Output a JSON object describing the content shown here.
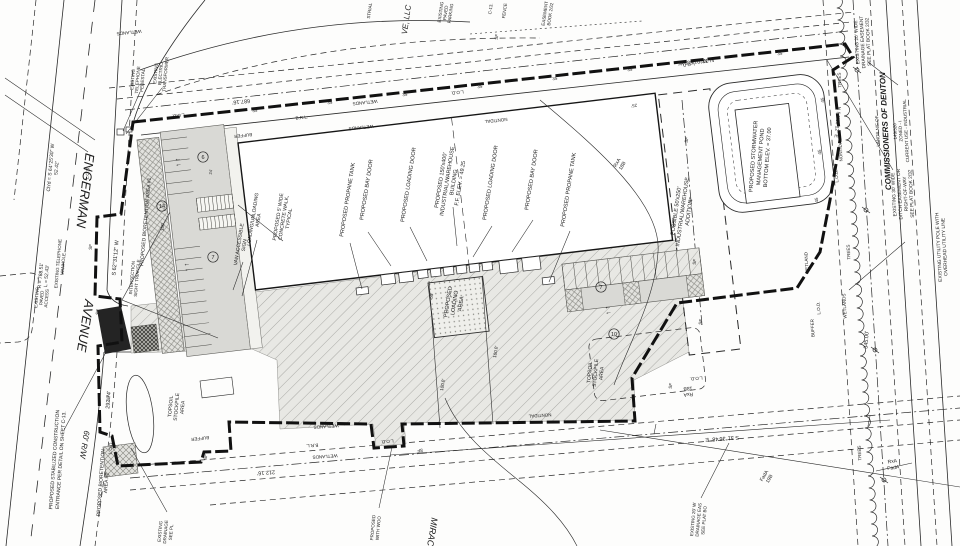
{
  "title": "Engerman Avenue Industrial/Warehouse Site Plan",
  "colors": {
    "ink": "#1c1c1c",
    "paper": "#fdfdfc",
    "parking_fill": "#d9d9d5",
    "pavement_fill": "#e8e8e4",
    "entrance_fill": "#242424"
  },
  "annotations": [
    {
      "n": "street-name-engerman",
      "t": "ENGERMAN",
      "x": 81,
      "y": 190,
      "r": 97,
      "fs": 13,
      "it": 1
    },
    {
      "n": "street-name-avenue",
      "t": "AVENUE",
      "x": 81,
      "y": 325,
      "r": 99,
      "fs": 13,
      "it": 1
    },
    {
      "n": "street-right-of-way",
      "t": "60' R/W",
      "x": 82,
      "y": 444,
      "r": 99,
      "fs": 8,
      "it": 1
    },
    {
      "n": "curve-chord-data",
      "t": "Ch'd = S 64°25'30\" W\n52.42'",
      "x": 55,
      "y": 168,
      "r": -85,
      "fs": 5,
      "lh": 6
    },
    {
      "n": "curve-radius-data",
      "t": "R = 788.51'\nL = 52.43'",
      "x": 45,
      "y": 276,
      "r": -85,
      "fs": 5,
      "lh": 6
    },
    {
      "n": "existing-telephone-manhole",
      "t": "EXISTING TELEPHONE\nMANHOLE",
      "x": 62,
      "y": 264,
      "r": -85,
      "fs": 4.5,
      "lh": 5
    },
    {
      "n": "existing-paved-access",
      "t": "EXISTING\nPAVED\nACCESS",
      "x": 43,
      "y": 298,
      "r": -85,
      "fs": 4.5,
      "lh": 5
    },
    {
      "n": "stabilized-construction-entrance",
      "t": "PROPOSED STABILIZED CONSTRUCTION\nENTRANCE PER DETAIL ON SHEET C-13.",
      "x": 59,
      "y": 460,
      "r": -86,
      "fs": 5,
      "lh": 6.5
    },
    {
      "n": "bioretention-area-2",
      "t": "PROPOSED BIORETENTION\nAREA #2",
      "x": 105,
      "y": 483,
      "r": -86,
      "fs": 5,
      "lh": 5.5
    },
    {
      "n": "existing-drainage-partial",
      "t": "EXISTING\nDRAINAGE\nSEE PL",
      "x": 167,
      "y": 532,
      "r": -85,
      "fs": 4.5,
      "lh": 5.5
    },
    {
      "n": "bearing-west-boundary",
      "t": "S 62°31'12\" W",
      "x": 117,
      "y": 258,
      "r": -85,
      "fs": 5.5
    },
    {
      "n": "dim-292",
      "t": "292.74'",
      "x": 110,
      "y": 400,
      "r": -85,
      "fs": 5.5
    },
    {
      "n": "intersection-sight-triangle",
      "t": "INTERSECTION\nSIGHT TRIANGLE",
      "x": 136,
      "y": 278,
      "r": -85,
      "fs": 4.5,
      "lh": 5
    },
    {
      "n": "bioretention-area-1",
      "t": "PROPOSED BIORETENTION AREA #1",
      "x": 147,
      "y": 222,
      "r": -85,
      "fs": 5
    },
    {
      "n": "existing-telephone-pedestal",
      "t": "EXISTING\nTELEPHONE\nPEDESTAL",
      "x": 139,
      "y": 80,
      "r": -85,
      "fs": 4.5,
      "lh": 5
    },
    {
      "n": "existing-electric-transformer",
      "t": "EXISTING\nELECTRIC\nTRANSFORMER",
      "x": 162,
      "y": 74,
      "r": -85,
      "fs": 4.5,
      "lh": 5
    },
    {
      "n": "adjacent-owner-partial",
      "t": "VE, LLC",
      "x": 409,
      "y": 20,
      "r": -82,
      "fs": 8,
      "it": 1
    },
    {
      "n": "industrial-partial",
      "t": "STRIAL",
      "x": 371,
      "y": 11,
      "r": -82,
      "fs": 4.5
    },
    {
      "n": "existing-paved-parking",
      "t": "EXISTING\nPAVED\nPARKING",
      "x": 447,
      "y": 13,
      "r": -82,
      "fs": 4.5,
      "lh": 5
    },
    {
      "n": "fence-label",
      "t": "FENCE",
      "x": 506,
      "y": 11,
      "r": -82,
      "fs": 4.5
    },
    {
      "n": "sheet-c13-label",
      "t": "C-13.",
      "x": 492,
      "y": 9,
      "r": -82,
      "fs": 4.5
    },
    {
      "n": "silt-fence-label",
      "t": "SF",
      "x": 498,
      "y": 37,
      "r": -82,
      "fs": 4.5
    },
    {
      "n": "easement-book-partial",
      "t": "EASEMENT\nBOOK 2/32",
      "x": 549,
      "y": 14,
      "r": -82,
      "fs": 4.5,
      "lh": 5.5
    },
    {
      "n": "dim-687",
      "t": "687.16'",
      "x": 241,
      "y": 100,
      "r": 174,
      "fs": 5.5
    },
    {
      "n": "bearing-top-boundary",
      "t": "N 32°01'58\" W",
      "x": 696,
      "y": 60,
      "r": 174,
      "fs": 5.5
    },
    {
      "n": "stormwater-pond-label",
      "t": "PROPOSED STORMWATER\nMANAGEMENT POND\nBOTTOM ELEV. = 37.00",
      "x": 762,
      "y": 157,
      "r": -86,
      "fs": 5.5,
      "lh": 7
    },
    {
      "n": "possible-addition-label",
      "t": "POSSIBLE 50'x250'\nINDUSTRIAL/WAREHOUSE\nADDITION",
      "x": 684,
      "y": 212,
      "r": -82,
      "fs": 5.5,
      "lh": 6.5
    },
    {
      "n": "building-label",
      "t": "PROPOSED 150'x400'\nINDUSTRIAL/WAREHOUSE\nBUILDING\nF.F. ELEV. = 49.25",
      "x": 452,
      "y": 182,
      "r": -81,
      "fs": 5.5,
      "lh": 6.5
    },
    {
      "n": "propane-tank-left",
      "t": "PROPOSED PROPANE TANK",
      "x": 349,
      "y": 200,
      "r": -81,
      "fs": 5.5
    },
    {
      "n": "bay-door-left",
      "t": "PROPOSED BAY DOOR",
      "x": 368,
      "y": 190,
      "r": -81,
      "fs": 5.5
    },
    {
      "n": "loading-door-left",
      "t": "PROPOSED LOADING DOOR",
      "x": 410,
      "y": 185,
      "r": -81,
      "fs": 5.5
    },
    {
      "n": "loading-door-right",
      "t": "PROPOSED LOADING DOOR",
      "x": 492,
      "y": 183,
      "r": -81,
      "fs": 5.5
    },
    {
      "n": "bay-door-right",
      "t": "PROPOSED BAY DOOR",
      "x": 533,
      "y": 180,
      "r": -81,
      "fs": 5.5
    },
    {
      "n": "propane-tank-right",
      "t": "PROPOSED PROPANE TANK",
      "x": 570,
      "y": 190,
      "r": -81,
      "fs": 5.5
    },
    {
      "n": "loading-area-label",
      "t": "PROPOSED\nLOADING\nAREA",
      "x": 456,
      "y": 303,
      "r": -81,
      "fs": 5.5,
      "lh": 6.5
    },
    {
      "n": "dim-55",
      "t": "55'",
      "x": 433,
      "y": 296,
      "r": -81,
      "fs": 4.5
    },
    {
      "n": "dim-100-left",
      "t": "100.0'",
      "x": 444,
      "y": 385,
      "r": -81,
      "fs": 4.5
    },
    {
      "n": "dim-100-right",
      "t": "100.0'",
      "x": 497,
      "y": 352,
      "r": -81,
      "fs": 4.5
    },
    {
      "n": "loading-unloading-area",
      "t": "LOADING/UNLOADING\nAREA",
      "x": 257,
      "y": 220,
      "r": -81,
      "fs": 5,
      "lh": 5.5
    },
    {
      "n": "van-accessible-sign",
      "t": "VAN ACCESSIBLE\nSIGN",
      "x": 243,
      "y": 245,
      "r": -81,
      "fs": 5,
      "lh": 5.5
    },
    {
      "n": "concrete-walk-label",
      "t": "PROPOSED 5' WIDE\nCONCRETE WALK,\nTYPICAL",
      "x": 285,
      "y": 218,
      "r": -81,
      "fs": 5,
      "lh": 5.5
    },
    {
      "n": "topsoil-stockpile-left",
      "t": "TOPSOIL\nSTOCKPILE\nAREA",
      "x": 178,
      "y": 407,
      "r": -85,
      "fs": 5,
      "lh": 6
    },
    {
      "n": "topsoil-stockpile-right",
      "t": "TOPSOIL\nSTOCKPILE\nAREA",
      "x": 597,
      "y": 373,
      "r": -85,
      "fs": 5,
      "lh": 6
    },
    {
      "n": "lands-nf-of",
      "t": "LANDS N/F OF",
      "x": 879,
      "y": 131,
      "r": -93,
      "fs": 4.5
    },
    {
      "n": "commissioners-of-denton",
      "t": "COMMISSIONERS OF DENTON",
      "x": 888,
      "y": 131,
      "r": -93,
      "fs": 8,
      "it": 1,
      "b": 1
    },
    {
      "n": "owner-parcel-details",
      "t": "149/320\nZONED - I\nCURRENT USE - INDUSTRIAL",
      "x": 902,
      "y": 131,
      "r": -93,
      "fs": 4.5,
      "lh": 5.5
    },
    {
      "n": "drainage-easement-ne",
      "t": "EXISTING 20' WIDE\nDRAINAGE EASEMENT\nSEE PLAT BOOK 2/32",
      "x": 864,
      "y": 42,
      "r": -93,
      "fs": 4.8,
      "lh": 5.8
    },
    {
      "n": "ditch-easement",
      "t": "EXISTING 30' WIDE\nDITCH EASEMENT OR\nRIGHT-OF-WAY\nSEE PLAT BOOK 2/32",
      "x": 904,
      "y": 194,
      "r": -93,
      "fs": 4.8,
      "lh": 5.8
    },
    {
      "n": "utility-pole-label",
      "t": "EXISTING UTILITY POLE WITH\nOVERHEAD UTILITY LINE",
      "x": 943,
      "y": 247,
      "r": -93,
      "fs": 4.8,
      "lh": 5.8
    },
    {
      "n": "bearing-ne",
      "t": "N 54°50'12\" E",
      "x": 836,
      "y": 122,
      "r": 95,
      "fs": 5
    },
    {
      "n": "dim-345",
      "t": "345.00'",
      "x": 868,
      "y": 340,
      "r": -86,
      "fs": 5.5
    },
    {
      "n": "bearing-bottom",
      "t": "S 31°36'48\" E",
      "x": 722,
      "y": 437,
      "r": 176,
      "fs": 5.5
    },
    {
      "n": "dim-212",
      "t": "212.16'",
      "x": 266,
      "y": 471,
      "r": 176,
      "fs": 5.5
    },
    {
      "n": "drainage-easement-se",
      "t": "EXISTING 20' W\nDRAINAGE EAS\nSEE PLAT BO",
      "x": 700,
      "y": 520,
      "r": -85,
      "fs": 4.5,
      "lh": 5.5
    },
    {
      "n": "proposed-wood-partial",
      "t": "PROPOSED\nWITH WOO",
      "x": 377,
      "y": 528,
      "r": -85,
      "fs": 4.5,
      "lh": 5.5
    },
    {
      "n": "miracle-partial",
      "t": "MIRACL",
      "x": 429,
      "y": 534,
      "r": 99,
      "fs": 9,
      "it": 1
    },
    {
      "n": "soil-label-rxa-1",
      "t": "RxA\n18B",
      "x": 621,
      "y": 165,
      "r": -60,
      "fs": 5,
      "lh": 6
    },
    {
      "n": "soil-label-rxa-2",
      "t": "RxA\n18B",
      "x": 688,
      "y": 390,
      "r": 176,
      "fs": 5,
      "lh": 6
    },
    {
      "n": "soil-label-fada",
      "t": "FadA\n19B",
      "x": 768,
      "y": 478,
      "r": -60,
      "fs": 5,
      "lh": 6
    },
    {
      "n": "soil-boundary-pair",
      "t": "RxA\nFadA",
      "x": 893,
      "y": 466,
      "r": -8,
      "fs": 5,
      "lh": 6.5
    },
    {
      "n": "wetlands-label",
      "t": "WETLANDS",
      "x": 129,
      "y": 31,
      "r": 174,
      "fs": 4.5
    },
    {
      "n": "wetlands-label",
      "t": "WETLANDS",
      "x": 365,
      "y": 101,
      "r": 174,
      "fs": 4.5
    },
    {
      "n": "wetlands-label",
      "t": "WETLANDS",
      "x": 361,
      "y": 126,
      "r": 174,
      "fs": 4.5
    },
    {
      "n": "wetlands-label",
      "t": "WETLANDS",
      "x": 326,
      "y": 425,
      "r": 176,
      "fs": 4.5
    },
    {
      "n": "wetlands-label",
      "t": "WETLANDS",
      "x": 325,
      "y": 455,
      "r": 176,
      "fs": 4.5
    },
    {
      "n": "wetlands-label",
      "t": "WETLANDS",
      "x": 846,
      "y": 306,
      "r": -93,
      "fs": 4.5
    },
    {
      "n": "wetland-label",
      "t": "WETLAND",
      "x": 808,
      "y": 263,
      "r": -93,
      "fs": 4.5
    },
    {
      "n": "nontidal-label",
      "t": "NONTIDAL",
      "x": 496,
      "y": 119,
      "r": 174,
      "fs": 4.5
    },
    {
      "n": "nontidal-label",
      "t": "NONTIDAL",
      "x": 842,
      "y": 150,
      "r": -93,
      "fs": 4.5
    },
    {
      "n": "nontidal-label",
      "t": "NONTIDAL",
      "x": 540,
      "y": 414,
      "r": 176,
      "fs": 4.5
    },
    {
      "n": "brl-label",
      "t": "B.R.L.",
      "x": 302,
      "y": 119,
      "r": -7,
      "fs": 4.5
    },
    {
      "n": "brl-label",
      "t": "B.R.L.",
      "x": 312,
      "y": 444,
      "r": 176,
      "fs": 4.5
    },
    {
      "n": "buffer-label",
      "t": "BUFFER",
      "x": 243,
      "y": 134,
      "r": 174,
      "fs": 4.5
    },
    {
      "n": "buffer-label",
      "t": "BUFFER",
      "x": 200,
      "y": 437,
      "r": 174,
      "fs": 4.5
    },
    {
      "n": "buffer-label",
      "t": "BUFFER",
      "x": 814,
      "y": 328,
      "r": -93,
      "fs": 4.5
    },
    {
      "n": "trees-label",
      "t": "TREES",
      "x": 841,
      "y": 80,
      "r": -93,
      "fs": 4.5
    },
    {
      "n": "trees-label",
      "t": "TREES",
      "x": 850,
      "y": 252,
      "r": -93,
      "fs": 4.5
    },
    {
      "n": "trees-label",
      "t": "TREES",
      "x": 861,
      "y": 453,
      "r": -93,
      "fs": 4.5
    },
    {
      "n": "lod-label",
      "t": "L.O.D.",
      "x": 89,
      "y": 173,
      "r": -85,
      "fs": 4.5
    },
    {
      "n": "lod-label",
      "t": "L.O.D.",
      "x": 178,
      "y": 114,
      "r": 174,
      "fs": 4.5
    },
    {
      "n": "lod-label",
      "t": "L.O.D.",
      "x": 457,
      "y": 91,
      "r": 174,
      "fs": 4.5
    },
    {
      "n": "lod-label",
      "t": "L.O.D.",
      "x": 688,
      "y": 63,
      "r": 174,
      "fs": 4.5
    },
    {
      "n": "lod-label",
      "t": "L.O.D.",
      "x": 838,
      "y": 176,
      "r": -93,
      "fs": 4.5
    },
    {
      "n": "lod-label",
      "t": "L.O.D.",
      "x": 820,
      "y": 308,
      "r": -93,
      "fs": 4.5
    },
    {
      "n": "lod-label",
      "t": "L.O.D.",
      "x": 696,
      "y": 377,
      "r": 176,
      "fs": 4.5
    },
    {
      "n": "lod-label",
      "t": "L.O.D.",
      "x": 112,
      "y": 448,
      "r": -85,
      "fs": 4.5
    },
    {
      "n": "lod-label",
      "t": "L.O.D.",
      "x": 387,
      "y": 440,
      "r": 176,
      "fs": 4.5
    },
    {
      "n": "silt-fence-label",
      "t": "SF",
      "x": 92,
      "y": 247,
      "r": -85,
      "fs": 4.5
    },
    {
      "n": "silt-fence-label",
      "t": "SF",
      "x": 99,
      "y": 312,
      "r": -85,
      "fs": 4.5
    },
    {
      "n": "silt-fence-label",
      "t": "SF",
      "x": 110,
      "y": 398,
      "r": -85,
      "fs": 4.5
    },
    {
      "n": "silt-fence-label",
      "t": "SF",
      "x": 207,
      "y": 457,
      "r": -85,
      "fs": 4.5
    },
    {
      "n": "silt-fence-label",
      "t": "SF",
      "x": 688,
      "y": 140,
      "r": -82,
      "fs": 4.5
    },
    {
      "n": "silt-fence-label",
      "t": "SF",
      "x": 692,
      "y": 200,
      "r": -82,
      "fs": 4.5
    },
    {
      "n": "silt-fence-label",
      "t": "SF",
      "x": 696,
      "y": 262,
      "r": -82,
      "fs": 4.5
    },
    {
      "n": "silt-fence-label",
      "t": "SF",
      "x": 702,
      "y": 322,
      "r": -82,
      "fs": 4.5
    },
    {
      "n": "silt-fence-label",
      "t": "SF",
      "x": 672,
      "y": 386,
      "r": -82,
      "fs": 4.5
    },
    {
      "n": "silt-fence-label",
      "t": "SF",
      "x": 420,
      "y": 449,
      "r": 176,
      "fs": 4.5
    },
    {
      "n": "contour-35",
      "t": "35",
      "x": 255,
      "y": 112,
      "r": -7,
      "fs": 4.5
    },
    {
      "n": "contour-35",
      "t": "35",
      "x": 330,
      "y": 104,
      "r": -7,
      "fs": 4.5
    },
    {
      "n": "contour-35",
      "t": "35",
      "x": 405,
      "y": 96,
      "r": -7,
      "fs": 4.5
    },
    {
      "n": "contour-35",
      "t": "35",
      "x": 480,
      "y": 88,
      "r": -7,
      "fs": 4.5
    },
    {
      "n": "contour-35",
      "t": "35",
      "x": 555,
      "y": 80,
      "r": -7,
      "fs": 4.5
    },
    {
      "n": "contour-35",
      "t": "35",
      "x": 630,
      "y": 71,
      "r": -7,
      "fs": 4.5
    },
    {
      "n": "contour-35",
      "t": "35",
      "x": 705,
      "y": 63,
      "r": -7,
      "fs": 4.5
    },
    {
      "n": "contour-35",
      "t": "35",
      "x": 780,
      "y": 55,
      "r": -7,
      "fs": 4.5
    },
    {
      "n": "contour-45",
      "t": "45",
      "x": 824,
      "y": 100,
      "r": -93,
      "fs": 4.5
    },
    {
      "n": "contour-45",
      "t": "45",
      "x": 821,
      "y": 152,
      "r": -93,
      "fs": 4.5
    },
    {
      "n": "contour-45",
      "t": "45",
      "x": 818,
      "y": 200,
      "r": -93,
      "fs": 4.5
    },
    {
      "n": "dim-25",
      "t": "25'",
      "x": 634,
      "y": 104,
      "r": 174,
      "fs": 4.5
    },
    {
      "n": "dim-150",
      "t": "150'",
      "x": 164,
      "y": 227,
      "r": -85,
      "fs": 4.5
    },
    {
      "n": "dim-24",
      "t": "24'",
      "x": 212,
      "y": 172,
      "r": -85,
      "fs": 4
    },
    {
      "n": "flow-arrows-icon",
      "t": "↑ ↑",
      "x": 180,
      "y": 162,
      "r": -98,
      "fs": 7
    },
    {
      "n": "flow-arrows-icon",
      "t": "↑ ↑",
      "x": 189,
      "y": 267,
      "r": -98,
      "fs": 7
    },
    {
      "n": "flow-arrows-icon",
      "t": "↑ ↑",
      "x": 610,
      "y": 310,
      "r": -98,
      "fs": 7
    }
  ],
  "parking_counts": [
    {
      "n": "stall-count-6",
      "v": "6",
      "x": 203,
      "y": 157
    },
    {
      "n": "stall-count-7",
      "v": "7",
      "x": 213,
      "y": 257
    },
    {
      "n": "stall-count-7b",
      "v": "7",
      "x": 601,
      "y": 287
    },
    {
      "n": "stall-count-10",
      "v": "10",
      "x": 614,
      "y": 334
    },
    {
      "n": "stall-count-14",
      "v": "14",
      "x": 162,
      "y": 206
    }
  ]
}
